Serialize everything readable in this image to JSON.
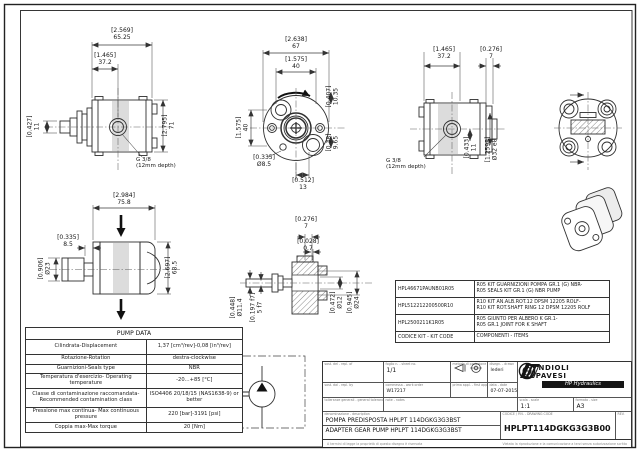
{
  "drawing": {
    "bg": "#ffffff",
    "line_color": "#2f2f2f",
    "band_color": "#dcdcdc"
  },
  "dims": {
    "v1": [
      {
        "i": "[2.569]",
        "m": "65.25"
      },
      {
        "i": "[1.465]",
        "m": "37.2"
      },
      {
        "i": "[0.427]",
        "m": "11"
      },
      {
        "i": "[2.795]",
        "m": "71"
      }
    ],
    "v2": [
      {
        "i": "[2.638]",
        "m": "67"
      },
      {
        "i": "[1.575]",
        "m": "40"
      },
      {
        "i": "[1.575]",
        "m": "40"
      },
      {
        "i": "[0.407]",
        "m": "10.35"
      },
      {
        "i": "[0.38]",
        "m": "9.65"
      },
      {
        "i": "[0.335]",
        "m": "Ø8.5"
      },
      {
        "i": "[0.512]",
        "m": "13"
      }
    ],
    "v3": [
      {
        "i": "[1.465]",
        "m": "37.2"
      },
      {
        "i": "[0.276]",
        "m": "7"
      },
      {
        "i": "[0.433]",
        "m": "11"
      },
      {
        "i": "[1.2598]",
        "m": "Ø32 e8"
      }
    ],
    "v5": [
      {
        "i": "[2.984]",
        "m": "75.8"
      },
      {
        "i": "[0.335]",
        "m": "8.5"
      },
      {
        "i": "[0.906]",
        "m": "Ø23"
      },
      {
        "i": "[2.697]",
        "m": "68.5"
      }
    ],
    "v6": [
      {
        "i": "[0.276]",
        "m": "7"
      },
      {
        "i": "[0.028]",
        "m": "0.7"
      },
      {
        "i": "[0.448]",
        "m": "Ø11.4"
      },
      {
        "i": "[0.197 f7]",
        "m": "5 f7"
      },
      {
        "i": "[0.472]",
        "m": "Ø12"
      },
      {
        "i": "[0.945]",
        "m": "Ø24"
      }
    ]
  },
  "notes": {
    "g38": "G 3/8",
    "g38_depth": "(12mm depth)"
  },
  "pump_data": {
    "title": "PUMP DATA",
    "rows": [
      {
        "label": "Cilindrata-Displacement",
        "value": "1,37 [cm³/rev]-0,08 [in³/rev]"
      },
      {
        "label": "Rotazione-Rotation",
        "value": "destra-clockwise"
      },
      {
        "label": "Guarnizioni-Seals type",
        "value": "NBR"
      },
      {
        "label": "Temperatura d'esercizio- Operating temperature",
        "value": "-20...+85 [°C]"
      },
      {
        "label": "Classe di contaminazione raccomandata- Recommended contamination class",
        "value": "ISO4406 20/18/15 (NAS1638-9) or better"
      },
      {
        "label": "Pressione max continua- Max continuous pressure",
        "value": "220 [bar]-3191 [psi]"
      },
      {
        "label": "Coppia max-Max torque",
        "value": "20 [Nm]"
      }
    ]
  },
  "kit_table": {
    "rows": [
      {
        "code": "HPL46671PAUNB01R05",
        "line1": "R05 KIT GUARNIZIONI POMPA GR.1 (G) NBR-",
        "line2": "R05 SEALS KIT GR.1 (G) NBR PUMP"
      },
      {
        "code": "HPL512212200500R10",
        "line1": "R10 KIT AN.ALB.ROT.12 DPSM 12205 ROLF-",
        "line2": "R10 KIT ROT.SHAFT RING 12 DPSM 12205 ROLF"
      },
      {
        "code": "HPL2500211K1R05",
        "line1": "R05 GIUNTO PER ALBERO K GR.1-",
        "line2": "R05 GR.1 JOINT FOR K SHAFT"
      }
    ],
    "footer_code": "CODICE KIT - KIT CODE",
    "footer_items": "COMPONENTI - ITEMS"
  },
  "title_block": {
    "labels": {
      "a1": "sost. del - repl. of",
      "a2": "foglio n. - sheet no.",
      "a3": "metodo di proiezione",
      "a4": "disegn. - drawn",
      "b1": "sost. dal - repl. by",
      "b2": "commessa - work order",
      "b3": "prima appl. - first appl.",
      "b4": "data - date",
      "c1": "tolleranze generali - general tolerances",
      "c2": "note - notes",
      "scale": "scala - scale",
      "size": "formato - size",
      "desc": "denominazione - description",
      "code": "CODICE / P.N. - DRAWING CODE",
      "rev": "REV."
    },
    "sheet": "1/1",
    "work_order": "W17217",
    "drawn_by": "lederi",
    "date": "07-07-2015",
    "scale": "1:1",
    "size": "A3",
    "company_line1": "BONDIOLI",
    "company_line2": "& PAVESI",
    "company_banner": "HP Hydraulics",
    "desc_it": "POMPA PREDISPOSTA HPLPT 114DGKG3G3BST",
    "desc_en": "ADAPTER GEAR PUMP HPLPT 114DGKG3G3BST",
    "code": "HPLPT114DGKG3G3B00",
    "footer_left": "A termini di legge la proprietà di questo disegno è riservata",
    "footer_right": "Vietata la riproduzione e la comunicazione a terzi senza autorizzazione scritta"
  }
}
